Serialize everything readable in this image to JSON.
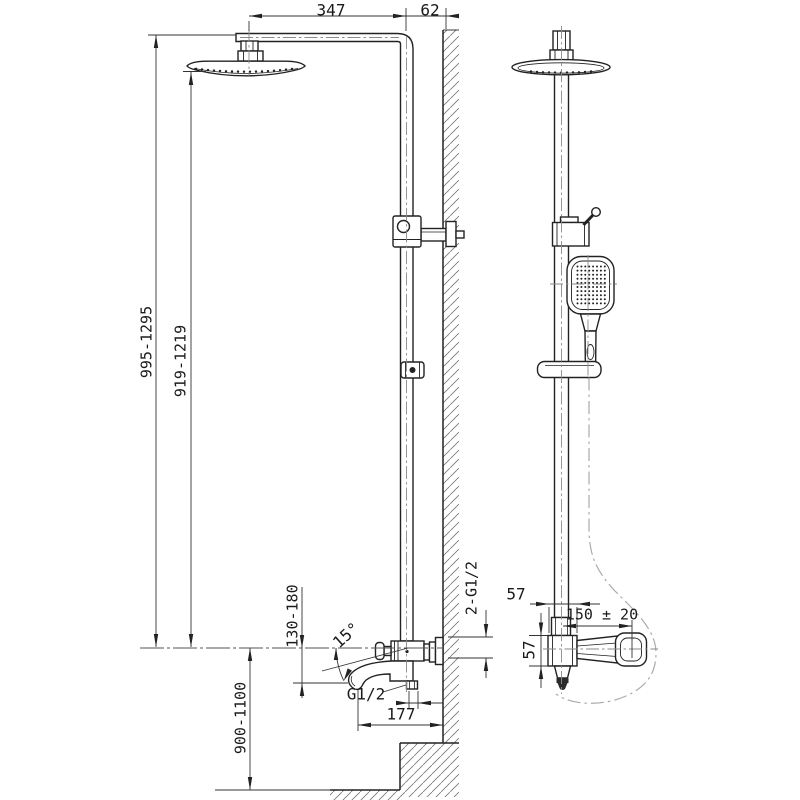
{
  "drawing": {
    "colors": {
      "line": "#222222",
      "centerline": "#8a8a8a",
      "hose": "#aaaaaa",
      "background": "#ffffff"
    },
    "dims": {
      "arm_reach": "347",
      "wall_offset": "62",
      "overall_height": "995-1295",
      "head_height": "919-1219",
      "spout_drop": "130-180",
      "mount_height": "900-1100",
      "spout_reach": "177",
      "spout_angle": "15°",
      "spout_thread": "G1/2",
      "inlet_thread": "2-G1/2",
      "body_width": "57",
      "body_height": "57",
      "inlet_spacing": "150 ± 20"
    }
  }
}
